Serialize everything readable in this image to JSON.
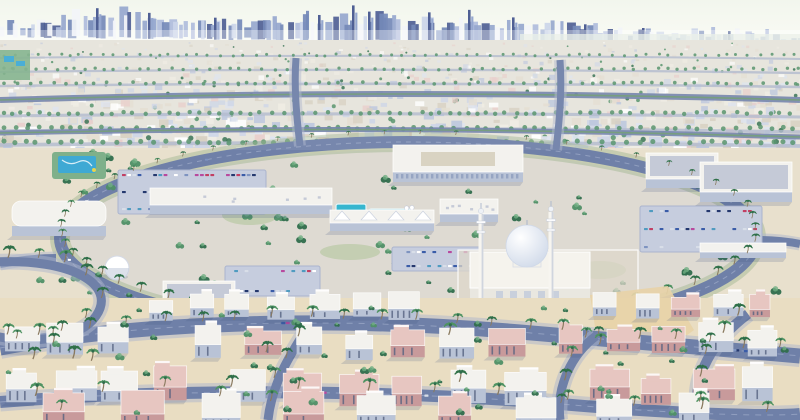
{
  "scene": {
    "description": "Aerial 3D architectural rendering of a planned desert city district: central mosque with two minarets and dome, commercial center with parking lots, palm-lined ring road, villa neighborhoods in the foreground, dense high-rise skyline on the horizon",
    "width": 800,
    "height": 420,
    "seed": 1377
  },
  "palette": {
    "sky_top": "#f2f6ec",
    "sky_bottom": "#fdfdfa",
    "haze": "#ffffff",
    "water_haze": "#eaf0e7",
    "sprawl_base": "#e6e4db",
    "midground": "#e8e0cd",
    "foreground": "#e9ddc2",
    "sand_lot": "#e7d3a8",
    "road": "#6f80a8",
    "road_dark": "#5a6b94",
    "road_side": "#aeb6cc",
    "road_dash": "#9aa6c6",
    "median_green": "#6f9878",
    "ring_verge": "#9db48e",
    "pave": "#c6cdde",
    "pave_edge": "#aab4cd",
    "wall_white": "#f3f2ee",
    "wall_shade": "#b9c3d6",
    "wall_pink": "#e7c6c1",
    "wall_pink_shade": "#c89a9b",
    "roof_grey": "#c5cad7",
    "window_dark": "#55617f",
    "tree_dark": "#2f6d4c",
    "tree_mid": "#4f8f66",
    "tree_light": "#6fae82",
    "palm_trunk": "#8a7a5f",
    "palm_frond": "#2f7148",
    "palm_frond2": "#4f9362",
    "pool_blue": "#36b6cf",
    "waterpark_blue": "#3fa9d4",
    "waterpark_green": "#7fb08a",
    "accent_yellow": "#e8d44d",
    "dome_light": "#ffffff",
    "dome_shade": "#c9d4e6",
    "shadow": "#3d5480",
    "lawn": "#a9c292"
  },
  "skyline": {
    "palette": [
      "#f2f4f8",
      "#aab8da",
      "#8fa2cc",
      "#6d82b4",
      "#c8d2e8",
      "#44568e"
    ],
    "spires": [
      {
        "x": 96,
        "h": 30
      },
      {
        "x": 148,
        "h": 26
      },
      {
        "x": 214,
        "h": 22
      },
      {
        "x": 318,
        "h": 26
      },
      {
        "x": 352,
        "h": 36
      },
      {
        "x": 368,
        "h": 30
      },
      {
        "x": 428,
        "h": 30
      },
      {
        "x": 468,
        "h": 33
      },
      {
        "x": 512,
        "h": 26
      },
      {
        "x": 584,
        "h": 20
      },
      {
        "x": 642,
        "h": 17
      },
      {
        "x": 728,
        "h": 15
      }
    ]
  },
  "sprawl": {
    "blocks": 840,
    "tree_ratio": 0.12,
    "palette": [
      "#ffffff",
      "#efece4",
      "#e3ddd0",
      "#ccd4e6",
      "#e8cdc9",
      "#b9c4dc",
      "#dde3ee",
      "#d6cfc0"
    ],
    "road_rows": [
      58,
      72,
      86,
      116,
      131,
      145
    ]
  },
  "boulevards": [
    {
      "d": "M0,100 C260,92 540,92 800,100",
      "w": 6
    },
    {
      "d": "M0,133 C300,127 520,129 800,137",
      "w": 5
    }
  ],
  "ring_road": {
    "cx": 408,
    "cy": 238,
    "rx": 348,
    "ry": 96
  },
  "connector_roads": [
    {
      "d": "M56,258 C30,258 12,262 0,264",
      "w": 8
    },
    {
      "d": "M760,240 C776,240 790,242 800,244",
      "w": 8
    },
    {
      "d": "M300,146 C296,112 294,84 296,58",
      "w": 7
    },
    {
      "d": "M556,150 C560,116 562,88 560,60",
      "w": 7
    },
    {
      "d": "M196,316 C164,352 140,384 128,420",
      "w": 9
    },
    {
      "d": "M636,314 C658,350 672,382 680,420",
      "w": 9
    }
  ],
  "streets": [
    {
      "name": "mainStreet",
      "d": "M0,348 C160,318 360,318 520,332 S760,352 800,356",
      "w": 15,
      "dash": true
    },
    {
      "name": "bottomStreet",
      "d": "M0,402 C200,386 420,392 560,404 S780,416 800,414",
      "w": 12,
      "dash": true
    },
    {
      "name": "leftLoop",
      "d": "M-5,262 C70,258 118,284 96,316 C80,340 30,344 -5,336",
      "w": 9,
      "dash": false
    },
    {
      "name": "vert1",
      "d": "M268,420 C272,382 292,352 306,330",
      "w": 9,
      "dash": false
    },
    {
      "name": "vert2",
      "d": "M560,420 C556,386 572,354 596,336",
      "w": 9,
      "dash": false
    },
    {
      "name": "rightRoad",
      "d": "M700,420 C688,376 716,338 748,314",
      "w": 10,
      "dash": false
    }
  ],
  "parking_lots": [
    {
      "x": 118,
      "y": 170,
      "w": 148,
      "h": 44,
      "rows": 3
    },
    {
      "x": 640,
      "y": 206,
      "w": 122,
      "h": 46,
      "rows": 3
    },
    {
      "x": 225,
      "y": 266,
      "w": 95,
      "h": 30,
      "rows": 2
    },
    {
      "x": 392,
      "y": 247,
      "w": 90,
      "h": 24,
      "rows": 2
    }
  ],
  "car_colors": [
    "#3a5ca8",
    "#ffffff",
    "#c23f63",
    "#7e93c0",
    "#24386e",
    "#b8499e",
    "#d8dee8",
    "#4f9bc0"
  ],
  "landmarks": {
    "school": {
      "x": 393,
      "y": 182,
      "w": 130,
      "d": 27,
      "h": 10
    },
    "commercial_strip": {
      "x": 150,
      "y": 214,
      "w": 182,
      "d": 17,
      "h": 9
    },
    "bigbox_right": [
      {
        "x": 646,
        "y": 188,
        "w": 72,
        "d": 26,
        "h": 9
      },
      {
        "x": 700,
        "y": 202,
        "w": 92,
        "d": 30,
        "h": 10
      }
    ],
    "community_left": {
      "x": 12,
      "y": 236,
      "w": 94,
      "d": 25,
      "h": 10
    },
    "clinic_left": {
      "x": 163,
      "y": 312,
      "w": 72,
      "d": 20,
      "h": 11
    },
    "warehouse_center": {
      "x": 295,
      "y": 334,
      "w": 88,
      "d": 22,
      "h": 12
    },
    "plaza_pavilion": {
      "x": 330,
      "y": 231,
      "w": 104,
      "d": 13,
      "h": 8
    },
    "shops_mid": {
      "x": 440,
      "y": 222,
      "w": 58,
      "d": 15,
      "h": 8
    },
    "wall_right": {
      "x": 700,
      "y": 258,
      "w": 86,
      "d": 9,
      "h": 6
    },
    "dome_pavilion": {
      "x": 117,
      "y": 268,
      "r": 12
    },
    "waterpark": {
      "x": 52,
      "y": 152,
      "w": 54,
      "h": 27
    },
    "plaza_pools": [
      [
        336,
        204,
        30,
        14
      ],
      [
        369,
        209,
        42,
        12
      ]
    ],
    "umbrella_colors": [
      "#ffffff",
      "#e3b8c6",
      "#bcd9e8"
    ],
    "sand_lot": "590,295 668,286 694,330 664,352 598,346",
    "lawns": [
      [
        250,
        215,
        28,
        10
      ],
      [
        600,
        270,
        26,
        9
      ],
      [
        350,
        252,
        30,
        8
      ]
    ],
    "mosque": {
      "hall_x": 470,
      "hall_y": 308,
      "hall_w": 120,
      "hall_d": 36,
      "hall_h": 20,
      "dome_x": 527,
      "dome_y": 246,
      "dome_r": 21,
      "minarets": [
        [
          481,
          206,
          302
        ],
        [
          551,
          204,
          300
        ]
      ]
    }
  },
  "villa_rows": [
    {
      "y": 318,
      "x0": 148,
      "x1": 430,
      "n": 7,
      "s": 0.95,
      "pink": 0.2
    },
    {
      "y": 316,
      "x0": 596,
      "x1": 792,
      "n": 5,
      "s": 0.9,
      "pink": 0.25
    },
    {
      "y": 352,
      "x0": 4,
      "x1": 140,
      "n": 3,
      "s": 1.1,
      "pink": 0.4
    },
    {
      "y": 357,
      "x0": 196,
      "x1": 540,
      "n": 7,
      "s": 1.1,
      "pink": 0.45
    },
    {
      "y": 354,
      "x0": 556,
      "x1": 796,
      "n": 5,
      "s": 1.05,
      "pink": 0.4
    },
    {
      "y": 400,
      "x0": 10,
      "x1": 200,
      "n": 4,
      "s": 1.25,
      "pink": 0.3
    },
    {
      "y": 404,
      "x0": 230,
      "x1": 560,
      "n": 6,
      "s": 1.3,
      "pink": 0.45
    },
    {
      "y": 402,
      "x0": 590,
      "x1": 790,
      "n": 4,
      "s": 1.25,
      "pink": 0.3
    },
    {
      "y": 428,
      "x0": 40,
      "x1": 760,
      "n": 9,
      "s": 1.35,
      "pink": 0.4
    }
  ],
  "palms": {
    "ring_arcs": [
      [
        80,
        280,
        6
      ],
      [
        -70,
        70,
        7
      ]
    ],
    "street_rows": [
      {
        "street": "mainStreet",
        "count": 22,
        "s": 1.15
      },
      {
        "street": "bottomStreet",
        "count": 12,
        "s": 1.3
      },
      {
        "street": "leftLoop",
        "count": 9,
        "s": 1.2
      },
      {
        "street": "vert1",
        "count": 4,
        "s": 1.2
      },
      {
        "street": "vert2",
        "count": 4,
        "s": 1.2
      },
      {
        "street": "rightRoad",
        "count": 5,
        "s": 1.25
      }
    ],
    "scatter_foreground": 10
  },
  "midtrees": {
    "count": 95
  },
  "shrubs": {
    "count": 48
  }
}
